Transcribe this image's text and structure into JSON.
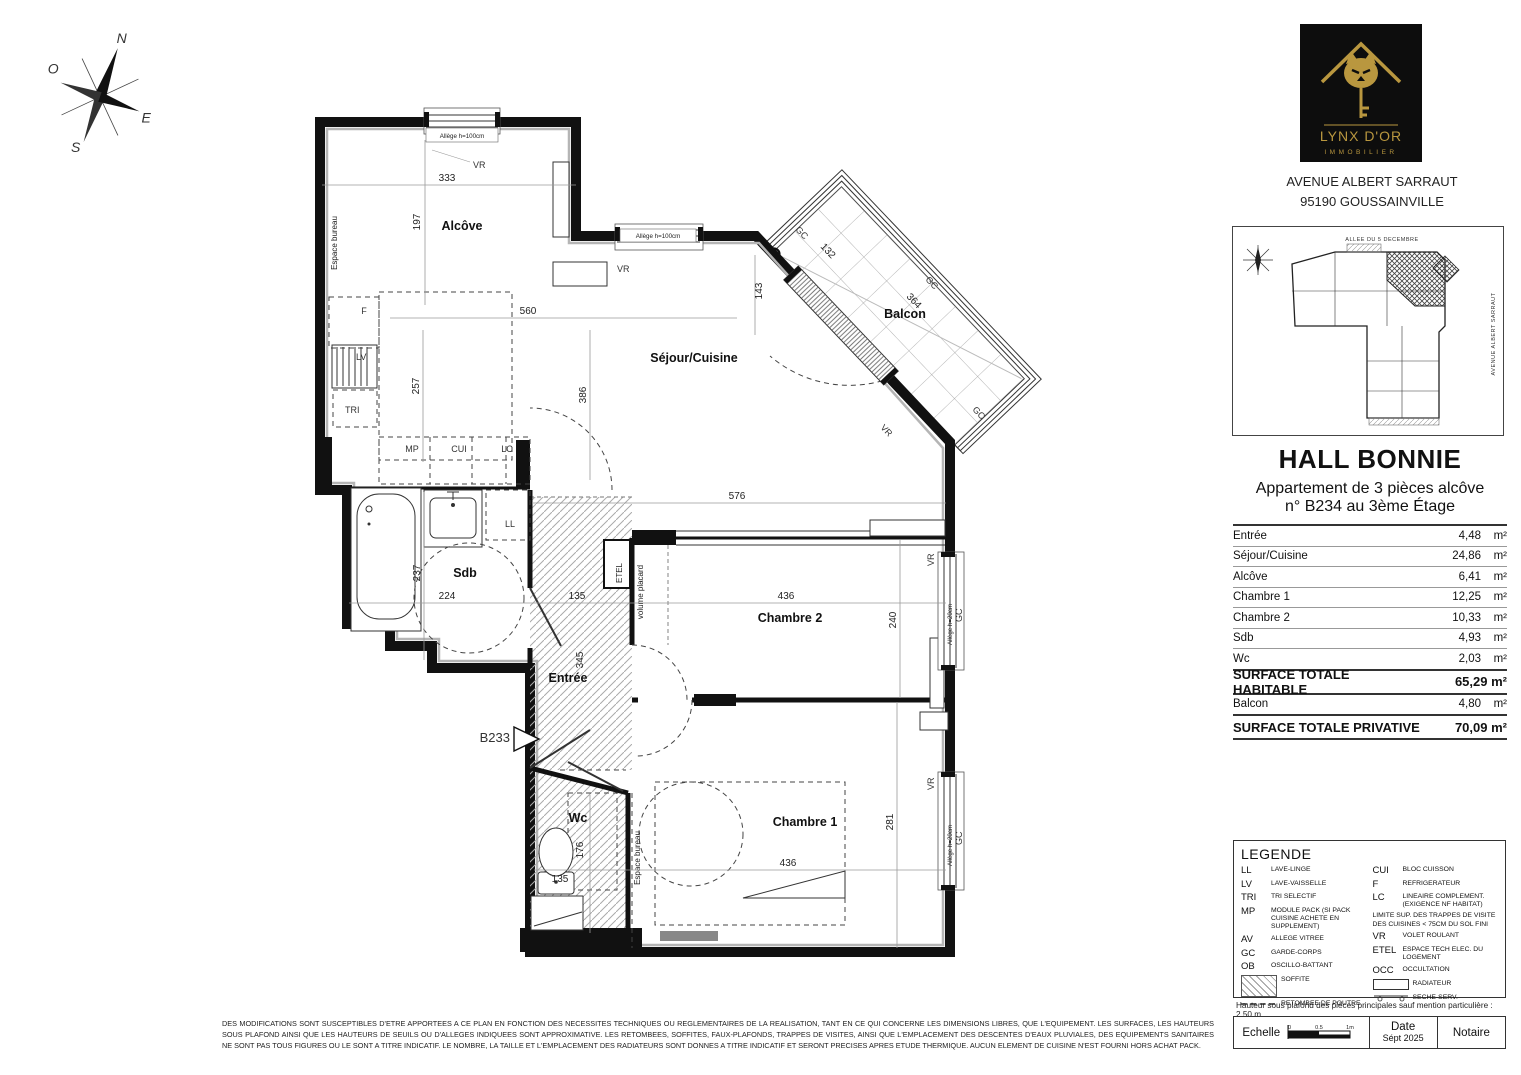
{
  "brand": {
    "name": "LYNX D'OR",
    "tagline": "IMMOBILIER",
    "address_line1": "AVENUE ALBERT SARRAUT",
    "address_line2": "95190 GOUSSAINVILLE",
    "gold": "#b9973f"
  },
  "siteplan": {
    "street_top": "ALLEE DU 5 DECEMBRE",
    "street_right": "AVENUE ALBERT SARRAUT"
  },
  "header": {
    "title": "HALL BONNIE",
    "subtitle_line1": "Appartement de 3 pièces alcôve",
    "subtitle_line2": "n° B234 au 3ème Étage"
  },
  "surfaces": {
    "rows": [
      {
        "label": "Entrée",
        "value": "4,48",
        "unit": "m²"
      },
      {
        "label": "Séjour/Cuisine",
        "value": "24,86",
        "unit": "m²"
      },
      {
        "label": "Alcôve",
        "value": "6,41",
        "unit": "m²"
      },
      {
        "label": "Chambre 1",
        "value": "12,25",
        "unit": "m²"
      },
      {
        "label": "Chambre 2",
        "value": "10,33",
        "unit": "m²"
      },
      {
        "label": "Sdb",
        "value": "4,93",
        "unit": "m²"
      },
      {
        "label": "Wc",
        "value": "2,03",
        "unit": "m²"
      }
    ],
    "total_habitable": {
      "label": "SURFACE TOTALE HABITABLE",
      "value": "65,29 m²"
    },
    "balcon": {
      "label": "Balcon",
      "value": "4,80",
      "unit": "m²"
    },
    "total_privative": {
      "label": "SURFACE TOTALE PRIVATIVE",
      "value": "70,09 m²"
    }
  },
  "legend": {
    "title": "LEGENDE",
    "left": [
      {
        "abbr": "LL",
        "text": "LAVE-LINGE"
      },
      {
        "abbr": "LV",
        "text": "LAVE-VAISSELLE"
      },
      {
        "abbr": "TRI",
        "text": "TRI SELECTIF"
      },
      {
        "abbr": "MP",
        "text": "MODULE PACK (SI PACK CUISINE ACHETE EN SUPPLEMENT)"
      },
      {
        "abbr": "AV",
        "text": "ALLEGE VITREE"
      },
      {
        "abbr": "GC",
        "text": "GARDE-CORPS"
      },
      {
        "abbr": "OB",
        "text": "OSCILLO-BATTANT"
      }
    ],
    "soffite": "SOFFITE",
    "retombee": "RETOMBEE DE POUTRE",
    "right": [
      {
        "abbr": "CUI",
        "text": "BLOC CUISSON"
      },
      {
        "abbr": "F",
        "text": "REFRIGERATEUR"
      },
      {
        "abbr": "LC",
        "text": "LINEAIRE COMPLEMENT. (EXIGENCE NF HABITAT)"
      }
    ],
    "note": "LIMITE SUP. DES TRAPPES DE VISITE DES CUISINES < 75CM DU SOL FINI",
    "right2": [
      {
        "abbr": "VR",
        "text": "VOLET ROULANT"
      },
      {
        "abbr": "ETEL",
        "text": "ESPACE TECH ELEC. DU LOGEMENT"
      },
      {
        "abbr": "OCC",
        "text": "OCCULTATION"
      }
    ],
    "radiateur": "RADIATEUR",
    "seche": "SECHE-SERV."
  },
  "ceiling_note": "Hauteur sous plafond des pièces principales sauf mention particulière : 2.50 m",
  "titleblock": {
    "echelle": "Echelle",
    "scale_ticks": [
      "0",
      "0.5",
      "1m"
    ],
    "date_label": "Date",
    "date_value": "Sépt 2025",
    "notaire": "Notaire"
  },
  "compass": {
    "n": "N",
    "s": "S",
    "e": "E",
    "o": "O"
  },
  "plan": {
    "rooms": {
      "alcove": "Alcôve",
      "sejour": "Séjour/Cuisine",
      "balcon": "Balcon",
      "sdb": "Sdb",
      "entree": "Entrée",
      "wc": "Wc",
      "chambre1": "Chambre 1",
      "chambre2": "Chambre 2"
    },
    "labels": {
      "espace_bureau": "Espace bureau",
      "volume_placard": "volume placard",
      "etel": "ETEL",
      "b233": "B233",
      "ll": "LL",
      "lv": "LV",
      "tri": "TRI",
      "mp": "MP",
      "cui": "CUI",
      "lc": "LC",
      "f": "F",
      "vr": "VR",
      "gc": "GC",
      "ep": "EP",
      "allege100": "Allège h=100cm",
      "allege20": "Allège h=20cm"
    },
    "dims": {
      "d333": "333",
      "d197": "197",
      "d143": "143",
      "d560": "560",
      "d257": "257",
      "d386": "386",
      "d576": "576",
      "d436": "436",
      "d240": "240",
      "d281": "281",
      "d237": "237",
      "d224": "224",
      "d135": "135",
      "d345": "345",
      "d176": "176",
      "d132": "132",
      "d364": "364"
    }
  },
  "disclaimer": "DES MODIFICATIONS SONT SUSCEPTIBLES D'ETRE APPORTEES A CE PLAN EN FONCTION DES NECESSITES TECHNIQUES OU REGLEMENTAIRES DE LA REALISATION, TANT EN CE QUI CONCERNE LES DIMENSIONS LIBRES, QUE L'EQUIPEMENT. LES SURFACES, LES HAUTEURS SOUS PLAFOND AINSI QUE LES HAUTEURS DE SEUILS OU D'ALLEGES INDIQUEES SONT APPROXIMATIVE. LES RETOMBEES, SOFFITES, FAUX-PLAFONDS, TRAPPES DE VISITES, AINSI QUE L'EMPLACEMENT DES DESCENTES D'EAUX PLUVIALES, DES EQUIPEMENTS SANITAIRES NE SONT PAS TOUS FIGURES OU LE SONT A TITRE INDICATIF. LE NOMBRE, LA TAILLE ET L'EMPLACEMENT DES RADIATEURS SONT DONNES A TITRE INDICATIF ET SERONT PRECISES APRES ETUDE THERMIQUE. AUCUN ELEMENT DE CUISINE N'EST FOURNI HORS ACHAT PACK."
}
